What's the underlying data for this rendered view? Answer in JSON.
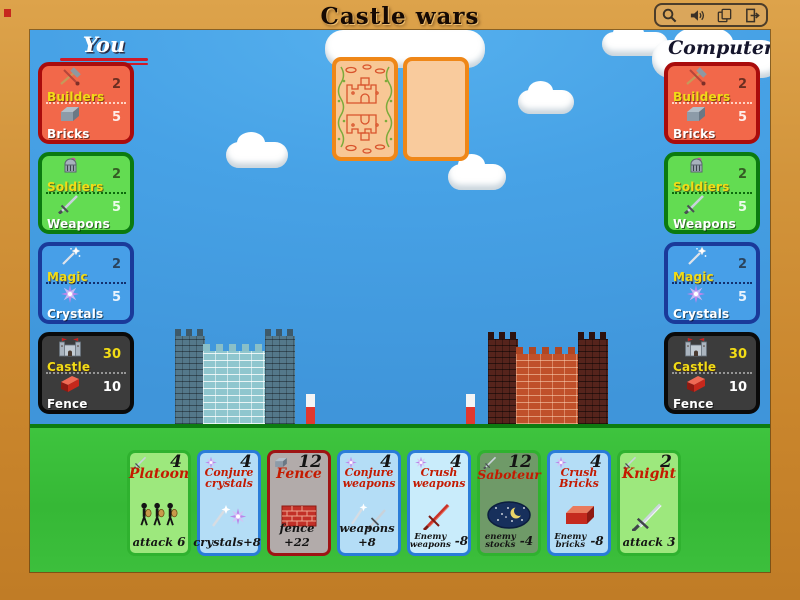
{
  "window": {
    "title": "Castle wars",
    "toolbar": {
      "buttons": [
        {
          "icon": "zoom-icon"
        },
        {
          "icon": "volume-icon"
        },
        {
          "icon": "cards-icon"
        },
        {
          "icon": "exit-icon"
        }
      ]
    }
  },
  "players": {
    "you": {
      "label": "You",
      "accent_underline_color": "#cf1a28",
      "panels": [
        {
          "top_icon": "builder-tools-icon",
          "top_label": "Builders",
          "top_value": "2",
          "bottom_icon": "brick-icon",
          "bottom_label": "Bricks",
          "bottom_value": "5",
          "bg": "#f2684a",
          "border": "#a90c0c"
        },
        {
          "top_icon": "soldier-helmet-icon",
          "top_label": "Soldiers",
          "top_value": "2",
          "bottom_icon": "sword-icon",
          "bottom_label": "Weapons",
          "bottom_value": "5",
          "bg": "#63dc52",
          "border": "#0b7a10"
        },
        {
          "top_icon": "magic-wand-icon",
          "top_label": "Magic",
          "top_value": "2",
          "bottom_icon": "crystal-icon",
          "bottom_label": "Crystals",
          "bottom_value": "5",
          "bg": "#479fe8",
          "border": "#1a3a9a"
        },
        {
          "top_icon": "castle-icon",
          "top_label": "Castle",
          "top_value": "30",
          "bottom_icon": "fence-brick-icon",
          "bottom_label": "Fence",
          "bottom_value": "10",
          "bg": "#3c3c3c",
          "border": "#0a0a0a"
        }
      ]
    },
    "computer": {
      "label": "Computer",
      "panels": [
        {
          "top_icon": "builder-tools-icon",
          "top_label": "Builders",
          "top_value": "2",
          "bottom_icon": "brick-icon",
          "bottom_label": "Bricks",
          "bottom_value": "5",
          "bg": "#f2684a",
          "border": "#a90c0c"
        },
        {
          "top_icon": "soldier-helmet-icon",
          "top_label": "Soldiers",
          "top_value": "2",
          "bottom_icon": "sword-icon",
          "bottom_label": "Weapons",
          "bottom_value": "5",
          "bg": "#63dc52",
          "border": "#0b7a10"
        },
        {
          "top_icon": "magic-wand-icon",
          "top_label": "Magic",
          "top_value": "2",
          "bottom_icon": "crystal-icon",
          "bottom_label": "Crystals",
          "bottom_value": "5",
          "bg": "#479fe8",
          "border": "#1a3a9a"
        },
        {
          "top_icon": "castle-icon",
          "top_label": "Castle",
          "top_value": "30",
          "bottom_icon": "fence-brick-icon",
          "bottom_label": "Fence",
          "bottom_value": "10",
          "bg": "#3c3c3c",
          "border": "#0a0a0a"
        }
      ]
    }
  },
  "board": {
    "draw_pile_style": "card-back",
    "played_slot_style": "empty",
    "left_castle_color": "#8fc6ce",
    "right_castle_color": "#c0502a",
    "fence_post_count": 2
  },
  "hand": {
    "cards": [
      {
        "title_lines": [
          "Platoon"
        ],
        "cost": "4",
        "cost_icon": "sword-icon",
        "art": "three-soldiers",
        "effect_label": "attack",
        "effect_value": "6",
        "bg": "#9de87d",
        "border": "#2fb22f"
      },
      {
        "title_lines": [
          "Conjure",
          "crystals"
        ],
        "cost": "4",
        "cost_icon": "crystal-icon",
        "art": "wand-and-crystal",
        "effect_label": "crystals+8",
        "effect_value": "",
        "bg": "#b4ddf6",
        "border": "#2a7cd8"
      },
      {
        "title_lines": [
          "Fence"
        ],
        "cost": "12",
        "cost_icon": "brick-icon",
        "art": "brick-wall",
        "effect_label": "fence +22",
        "effect_value": "",
        "bg": "#b2abaa",
        "border": "#9e1414"
      },
      {
        "title_lines": [
          "Conjure",
          "weapons"
        ],
        "cost": "4",
        "cost_icon": "crystal-icon",
        "art": "wand-and-sword",
        "effect_label": "weapons +8",
        "effect_value": "",
        "bg": "#b4ddf6",
        "border": "#2a7cd8"
      },
      {
        "title_lines": [
          "Crush",
          "weapons"
        ],
        "cost": "4",
        "cost_icon": "crystal-icon",
        "art": "red-sword",
        "effect_label": "Enemy\nweapons",
        "effect_value": "-8",
        "bg": "#c9ecfb",
        "border": "#2a7cd8"
      },
      {
        "title_lines": [
          "Saboteur"
        ],
        "cost": "12",
        "cost_icon": "sword-icon",
        "art": "night-moon",
        "effect_label": "enemy\nstocks",
        "effect_value": "-4",
        "bg": "#6f9a68",
        "border": "#2fb22f"
      },
      {
        "title_lines": [
          "Crush",
          "Bricks"
        ],
        "cost": "4",
        "cost_icon": "crystal-icon",
        "art": "red-brick",
        "effect_label": "Enemy\nbricks",
        "effect_value": "-8",
        "bg": "#b4ddf6",
        "border": "#2a7cd8"
      },
      {
        "title_lines": [
          "Knight"
        ],
        "cost": "2",
        "cost_icon": "sword-icon",
        "art": "big-sword",
        "effect_label": "attack",
        "effect_value": "3",
        "bg": "#9de87d",
        "border": "#2fb22f"
      }
    ]
  }
}
